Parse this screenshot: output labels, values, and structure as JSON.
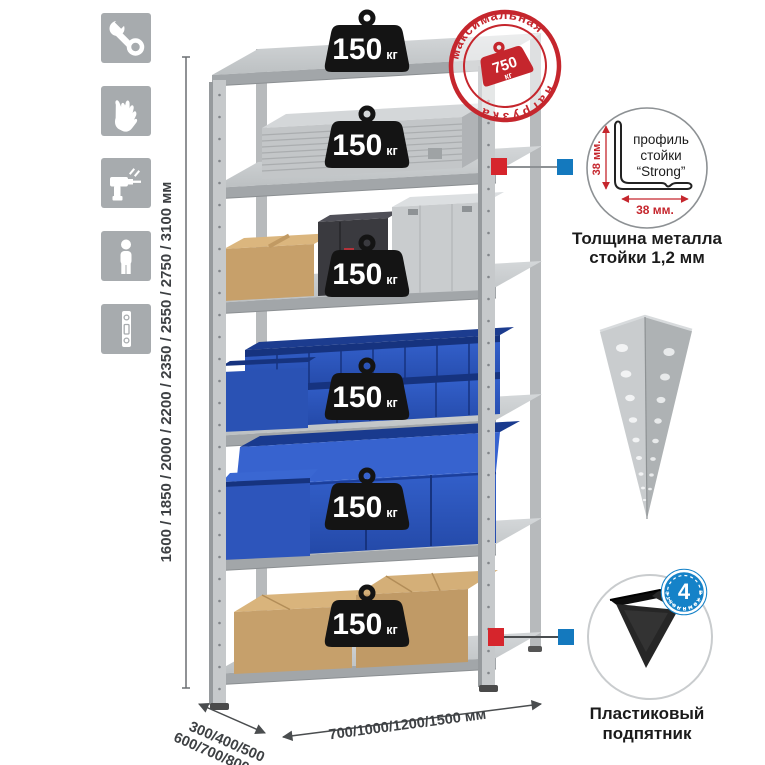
{
  "assembly_icons": [
    {
      "icon": "wrench-icon"
    },
    {
      "icon": "work-gloves-icon"
    },
    {
      "icon": "drill-icon"
    },
    {
      "icon": "person-icon"
    },
    {
      "icon": "level-icon"
    }
  ],
  "dimensions": {
    "height_options": "1600 / 1850 / 2000 / 2200 / 2350 / 2550 / 2750 / 3100 мм",
    "depth_options_line1": "300/400/500",
    "depth_options_line2": "600/700/800 мм",
    "width_options": "700/1000/1200/1500 мм"
  },
  "shelf_loads": [
    {
      "value": "150",
      "unit": "кг"
    },
    {
      "value": "150",
      "unit": "кг"
    },
    {
      "value": "150",
      "unit": "кг"
    },
    {
      "value": "150",
      "unit": "кг"
    },
    {
      "value": "150",
      "unit": "кг"
    },
    {
      "value": "150",
      "unit": "кг"
    }
  ],
  "max_load_stamp": {
    "arc_top": "максимальная",
    "arc_bottom": "нагрузка",
    "value": "750",
    "unit": "кг"
  },
  "profile_detail": {
    "height_label": "38 мм.",
    "width_label": "38 мм.",
    "name_line1": "профиль",
    "name_line2": "стойки",
    "name_line3": "“Strong”",
    "caption_line1": "Толщина металла",
    "caption_line2": "стойки 1,2 мм"
  },
  "foot_detail": {
    "badge_count": "4",
    "badge_label": "в комплекте",
    "caption_line1": "Пластиковый",
    "caption_line2": "подпятник"
  },
  "colors": {
    "accent_red": "#c5262d",
    "accent_blue": "#1582c8",
    "bin_blue": "#2d5ac1",
    "metal_gray": "#c6c9cb",
    "icon_tile_gray": "#a7abae"
  }
}
